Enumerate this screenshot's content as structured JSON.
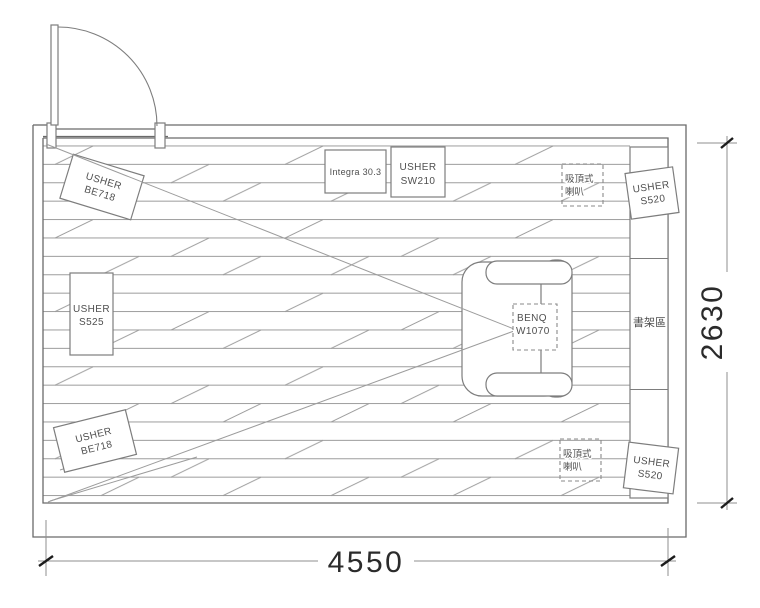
{
  "labels": {
    "front_left_speaker": {
      "brand": "USHER",
      "model": "BE718"
    },
    "rear_left_speaker": {
      "brand": "USHER",
      "model": "BE718"
    },
    "center_speaker": {
      "brand": "USHER",
      "model": "S525"
    },
    "amplifier": {
      "name": "Integra 30.3"
    },
    "subwoofer": {
      "brand": "USHER",
      "model": "SW210"
    },
    "surround_top_speaker": {
      "brand": "USHER",
      "model": "S520"
    },
    "surround_bottom_speaker": {
      "brand": "USHER",
      "model": "S520"
    },
    "ceiling_speaker_top": {
      "line1": "吸頂式",
      "line2": "喇叭"
    },
    "ceiling_speaker_bottom": {
      "line1": "吸頂式",
      "line2": "喇叭"
    },
    "projector": {
      "brand": "BENQ",
      "model": "W1070"
    },
    "bookshelf_area": {
      "text": "書架區"
    }
  },
  "dimensions": {
    "width": "4550",
    "height": "2630"
  },
  "colors": {
    "wall_line": "#6a6a6a",
    "hatch_line": "#9c9c9c",
    "label_text": "#4f4f4f",
    "dimension_text": "#2b2b2b"
  }
}
